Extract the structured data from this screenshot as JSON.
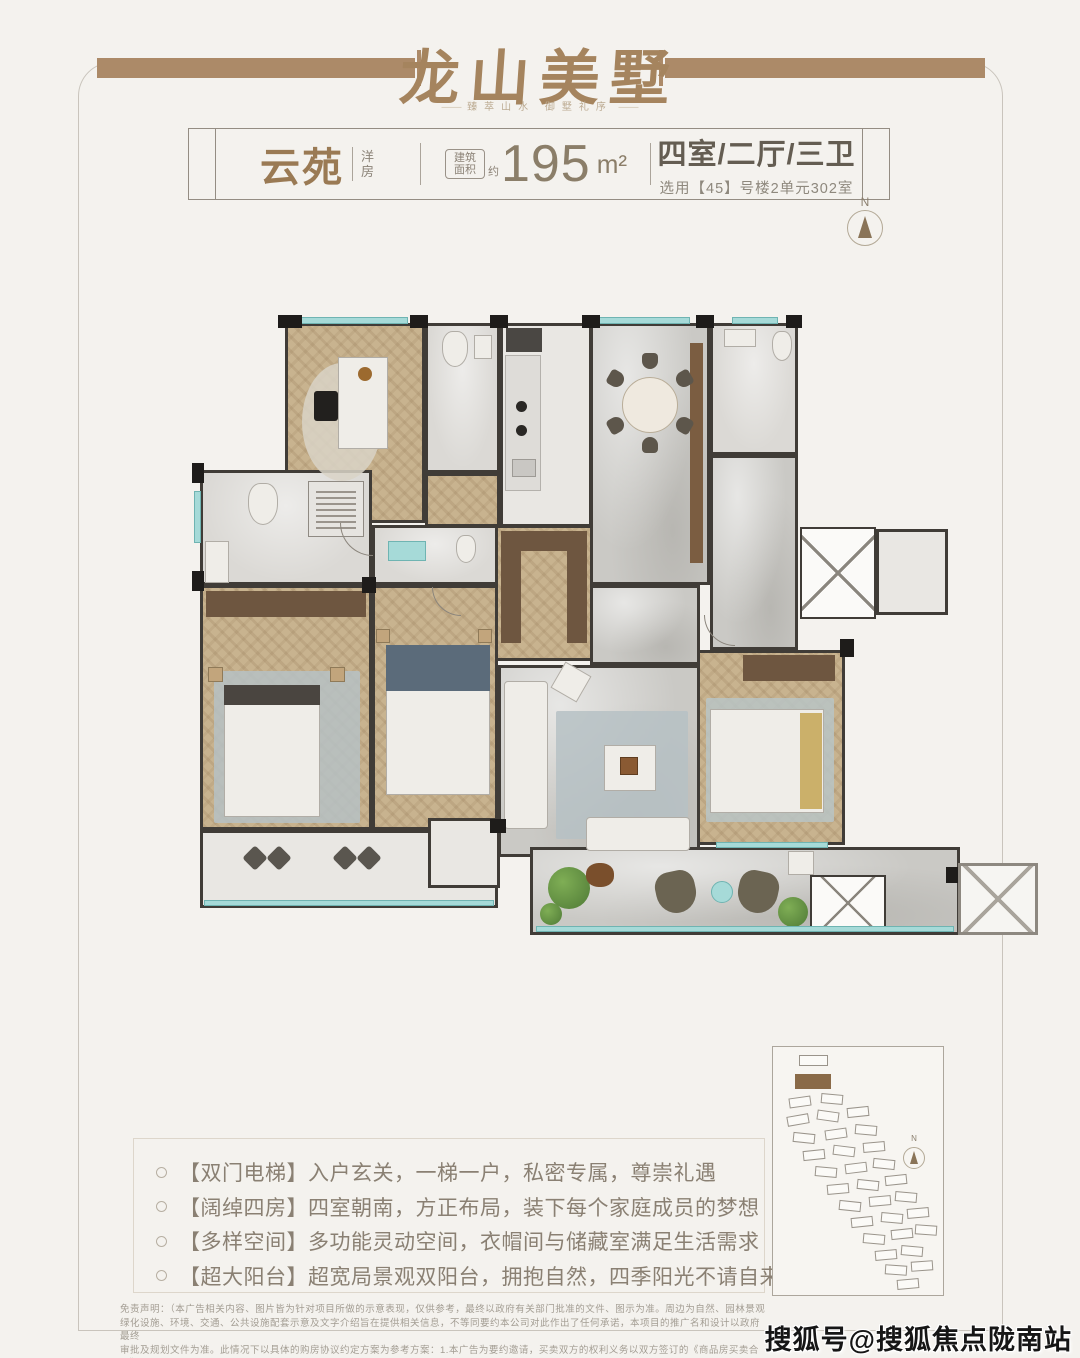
{
  "header": {
    "title": "龙山美墅",
    "tagline": "臻萃山水  御墅礼序"
  },
  "info_bar": {
    "name": "云苑",
    "type_vertical": "洋房",
    "area_badge_line1": "建筑",
    "area_badge_line2": "面积",
    "area_approx": "约",
    "area_value": "195",
    "area_unit": "m²",
    "layout": "四室/二厅/三卫",
    "layout_sub": "选用【45】号楼2单元302室"
  },
  "compass": {
    "label": "N"
  },
  "features": {
    "items": [
      {
        "tag": "【双门电梯】",
        "text": "入户玄关，一梯一户，私密专属，尊崇礼遇"
      },
      {
        "tag": "【阔绰四房】",
        "text": "四室朝南，方正布局，装下每个家庭成员的梦想"
      },
      {
        "tag": "【多样空间】",
        "text": "多功能灵动空间，衣帽间与储藏室满足生活需求"
      },
      {
        "tag": "【超大阳台】",
        "text": "超宽局景观双阳台，拥抱自然，四季阳光不请自来"
      }
    ]
  },
  "site_plan": {
    "compass_label": "N",
    "buildings": [
      {
        "x": 26,
        "y": 8,
        "w": 27,
        "h": 9,
        "r": 0
      },
      {
        "x": 22,
        "y": 27,
        "w": 34,
        "h": 13,
        "r": 0,
        "hl": true
      },
      {
        "x": 16,
        "y": 50,
        "r": -8
      },
      {
        "x": 48,
        "y": 47,
        "r": 5
      },
      {
        "x": 14,
        "y": 68,
        "r": -10
      },
      {
        "x": 44,
        "y": 64,
        "r": 8
      },
      {
        "x": 74,
        "y": 60,
        "r": -6
      },
      {
        "x": 20,
        "y": 86,
        "r": 6
      },
      {
        "x": 52,
        "y": 82,
        "r": -8
      },
      {
        "x": 82,
        "y": 78,
        "r": 5
      },
      {
        "x": 30,
        "y": 103,
        "r": -6
      },
      {
        "x": 60,
        "y": 99,
        "r": 7
      },
      {
        "x": 90,
        "y": 95,
        "r": -5
      },
      {
        "x": 42,
        "y": 120,
        "r": 5
      },
      {
        "x": 72,
        "y": 116,
        "r": -7
      },
      {
        "x": 100,
        "y": 112,
        "r": 6
      },
      {
        "x": 54,
        "y": 137,
        "r": -5
      },
      {
        "x": 84,
        "y": 133,
        "r": 6
      },
      {
        "x": 112,
        "y": 128,
        "r": -6
      },
      {
        "x": 66,
        "y": 154,
        "r": 6
      },
      {
        "x": 96,
        "y": 149,
        "r": -5
      },
      {
        "x": 122,
        "y": 145,
        "r": 5
      },
      {
        "x": 78,
        "y": 170,
        "r": -6
      },
      {
        "x": 108,
        "y": 166,
        "r": 5
      },
      {
        "x": 134,
        "y": 161,
        "r": -5
      },
      {
        "x": 90,
        "y": 187,
        "r": 5
      },
      {
        "x": 118,
        "y": 182,
        "r": -6
      },
      {
        "x": 142,
        "y": 178,
        "r": 4
      },
      {
        "x": 102,
        "y": 203,
        "r": -5
      },
      {
        "x": 128,
        "y": 199,
        "r": 5
      },
      {
        "x": 112,
        "y": 218,
        "r": 4
      },
      {
        "x": 138,
        "y": 214,
        "r": -4
      },
      {
        "x": 124,
        "y": 232,
        "r": -5
      }
    ]
  },
  "disclaimer": {
    "lines": [
      "免责声明：（本广告相关内容、图片皆为针对项目所做的示意表现，仅供参考，最终以政府有关部门批准的文件、图示为准。周边为自然、园林景观",
      "绿化设施、环境、交通、公共设施配套示意及文字介绍旨在提供相关信息，不等同要约本公司对此作出了任何承诺，本项目的推广名和设计以政府最终",
      "审批及规划文件为准。此情况下以具体的购房协议约定方案为参考方案：1.本广告为要约邀请，买卖双方的权利义务以双方签订的《商品房买卖合同》",
      "及补充协议为准。2.本广告相关面积均为建筑面积，最终计算面积以测绘机构实测面积为准。3.广告中涉及户型结构、装修展示及相关材料仅作示意。"
    ]
  },
  "watermark": {
    "text": "搜狐号@搜狐焦点陇南站"
  },
  "colors": {
    "accent_brown": "#ac8a68",
    "title_brown": "#a5845e",
    "wall": "#403c37",
    "wood_floor": "#c8b38f",
    "marble_floor": "#cac9c5",
    "window_teal": "#a6dad8",
    "text_gray": "#8a8073",
    "highlight_building": "#8a6a48"
  }
}
